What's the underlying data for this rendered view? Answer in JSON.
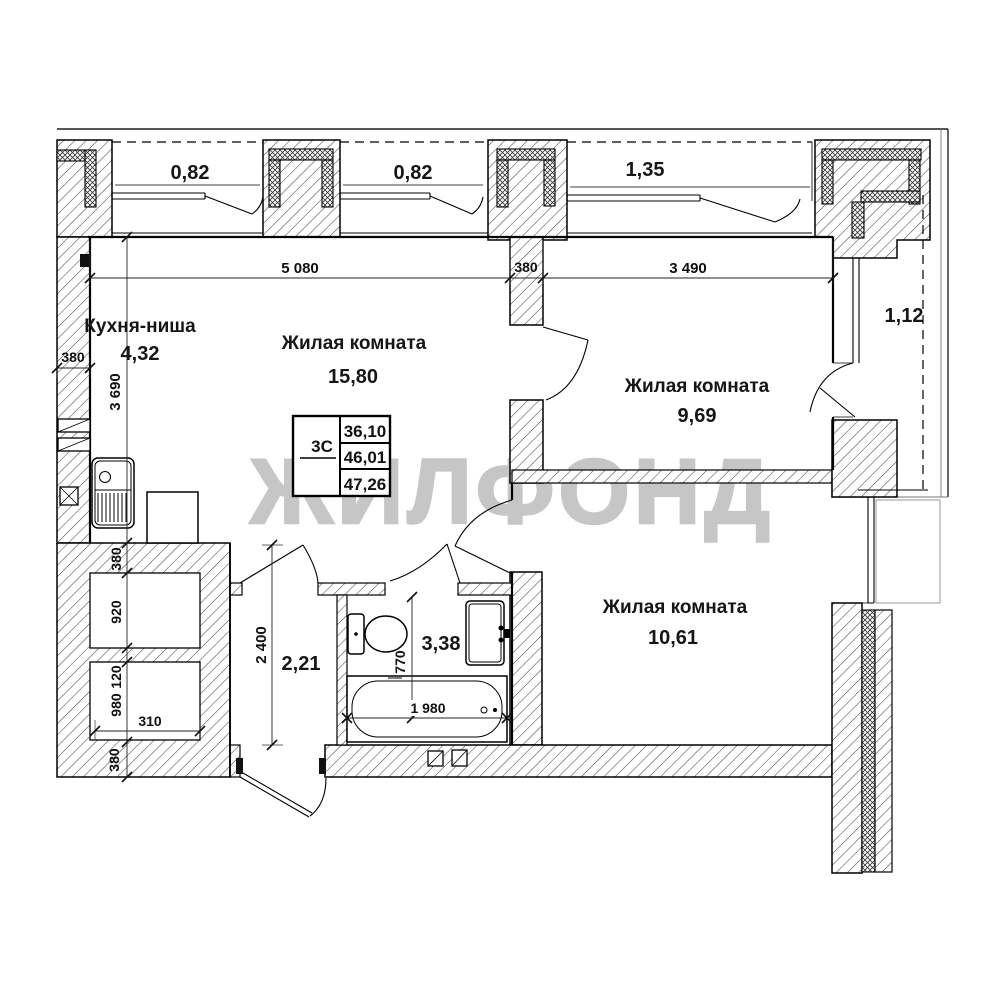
{
  "watermark": "ЖИЛФОНД",
  "rooms": {
    "kitchen": {
      "name": "Кухня-ниша",
      "area": "4,32"
    },
    "living_main": {
      "name": "Жилая комната",
      "area": "15,80"
    },
    "living_right": {
      "name": "Жилая комната",
      "area": "9,69"
    },
    "living_bottom": {
      "name": "Жилая комната",
      "area": "10,61"
    },
    "hallway": {
      "area": "2,21"
    },
    "bathroom": {
      "area": "3,38"
    }
  },
  "balconies": {
    "top_left": "0,82",
    "top_mid": "0,82",
    "top_right": "1,35",
    "right": "1,12"
  },
  "info_table": {
    "flat_type": "3С",
    "living_area": "36,10",
    "floor_area": "46,01",
    "total_area": "47,26"
  },
  "dimensions": {
    "top_width_left": "5 080",
    "top_wall": "380",
    "top_width_right": "3 490",
    "left_wall": "380",
    "kitchen_depth": "3 690",
    "niche_chain": [
      "380",
      "920",
      "120",
      "980"
    ],
    "niche_width": "310",
    "bottom_wall": "380",
    "hall_depth": "2 400",
    "bath_width": "770",
    "bath_length": "1 980"
  },
  "colors": {
    "watermark_gray": "#c6c6c6",
    "line_black": "#000000",
    "neighbor_gray": "#999999"
  }
}
